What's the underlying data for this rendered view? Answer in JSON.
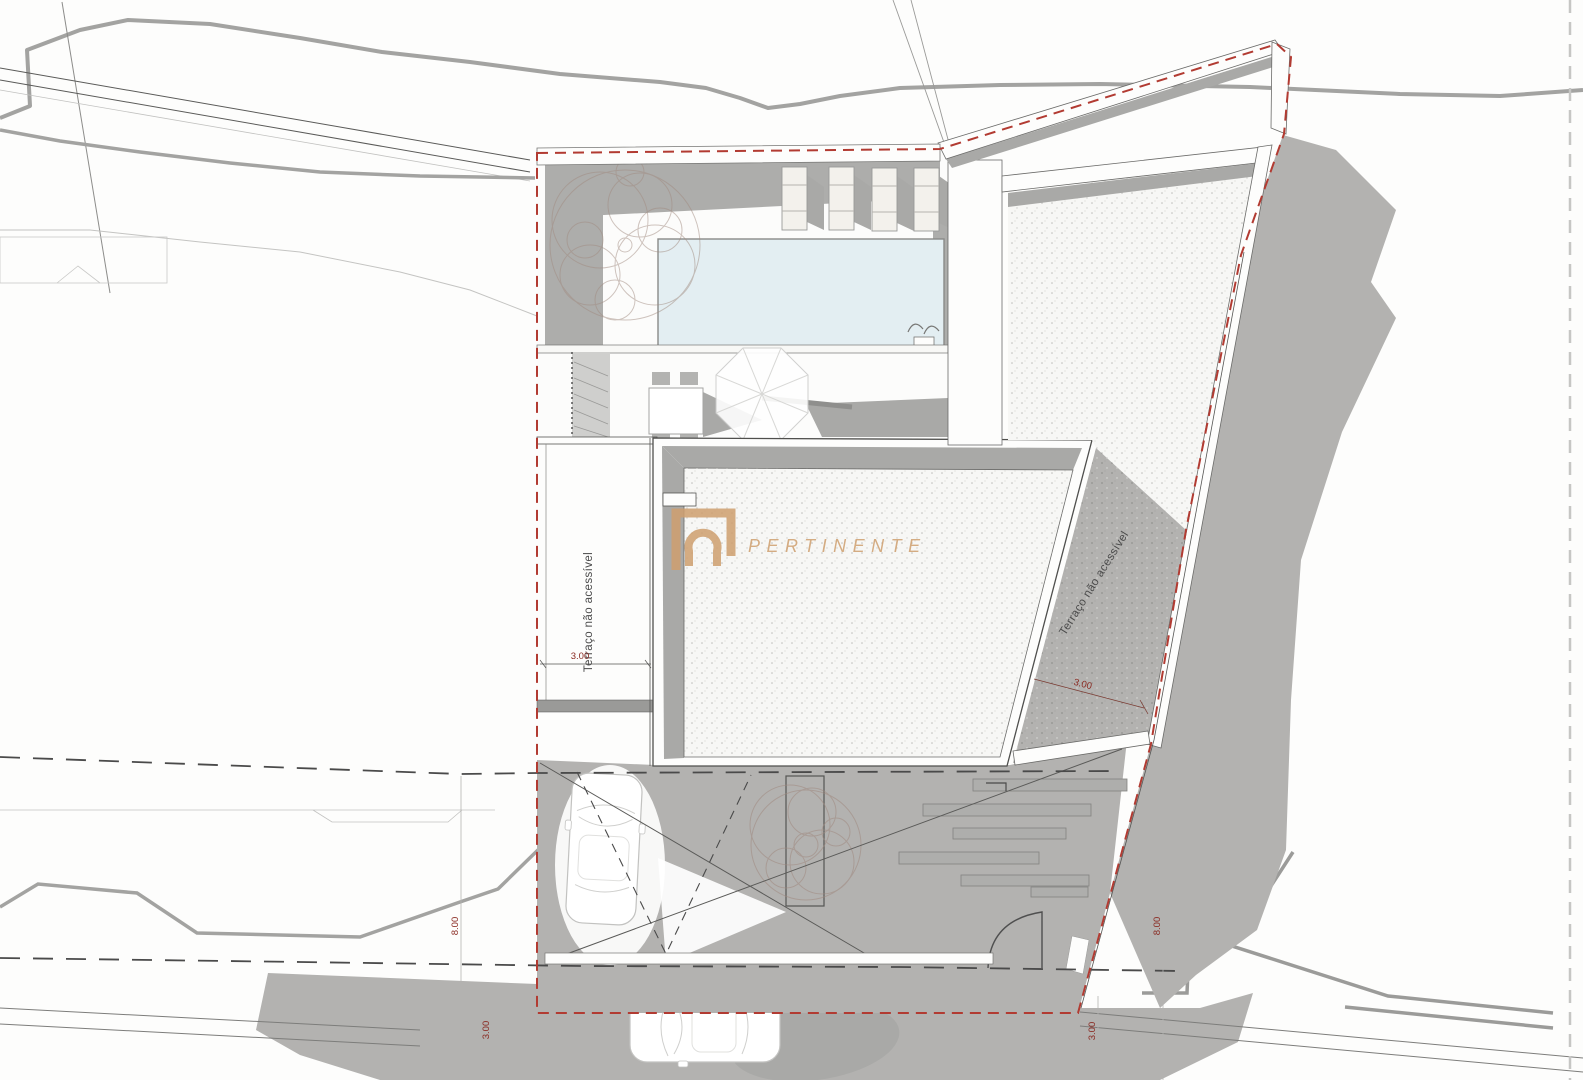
{
  "document": {
    "type": "architectural roof / site plan drawing",
    "background": "#fdfdfc"
  },
  "watermark": {
    "brand": "PERTINENTE",
    "logo": "keyhole-arch-icon",
    "color": "#cf9f6f"
  },
  "labels": {
    "terrace_left": "Terraço não acessível",
    "terrace_right": "Terraço não acessível"
  },
  "dimensions": {
    "terrace_left_width": "3.00",
    "terrace_right_width": "3.00",
    "setback_west": "8.00",
    "setback_east": "8.00",
    "street_west": "3.00",
    "street_east": "3.00"
  },
  "colors": {
    "boundary_red": "#b23b32",
    "dimension_red": "#8a2a22",
    "shadow_gray": "#b3b2b0",
    "roof_stipple": "#f7f7f5",
    "pool_blue": "#e3eef2",
    "watermark_tan": "#cf9f6f"
  }
}
